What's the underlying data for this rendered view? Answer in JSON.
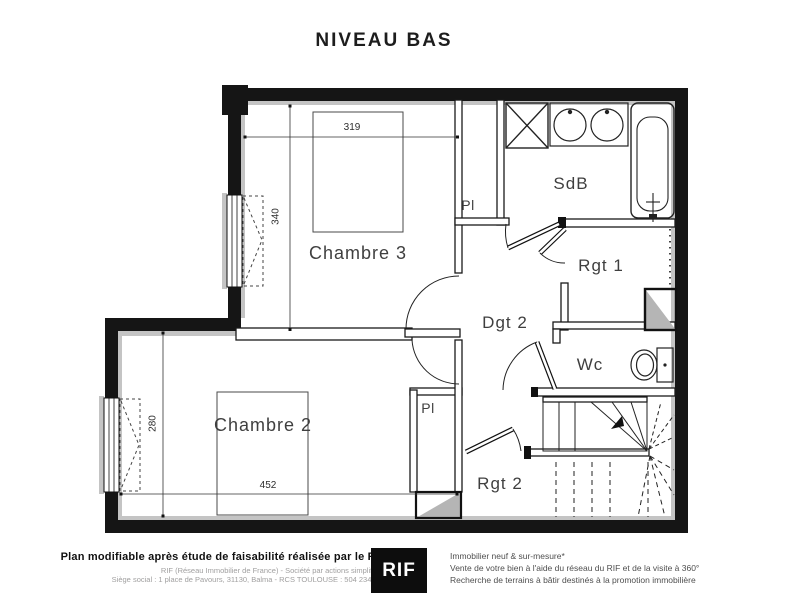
{
  "title": "NIVEAU BAS",
  "rooms": {
    "chambre3": "Chambre 3",
    "chambre2": "Chambre 2",
    "sdb": "SdB",
    "rgt1": "Rgt 1",
    "dgt2": "Dgt 2",
    "wc": "Wc",
    "rgt2": "Rgt 2",
    "pl_top": "Pl",
    "pl_bottom": "Pl"
  },
  "dims": {
    "d319": "319",
    "d340": "340",
    "d280": "280",
    "d452": "452"
  },
  "footer": {
    "left": {
      "headline": "Plan modifiable après étude de faisabilité réalisée par le RIF",
      "line1": "RIF (Réseau Immobilier de France) - Société par actions simplifiées",
      "line2": "Siège social : 1 place de Pavours, 31130, Balma - RCS TOULOUSE : 504 234 174"
    },
    "logo_text": "RIF",
    "right": {
      "line1": "Immobilier neuf & sur-mesure*",
      "line2": "Vente de votre bien à l'aide du réseau du RIF et de la visite à 360°",
      "line3": "Recherche de terrains à bâtir destinés à la promotion immobilière"
    }
  },
  "colors": {
    "wall": "#151515",
    "lining": "#c4c4c4",
    "duct_fill": "#b5b5b5"
  }
}
